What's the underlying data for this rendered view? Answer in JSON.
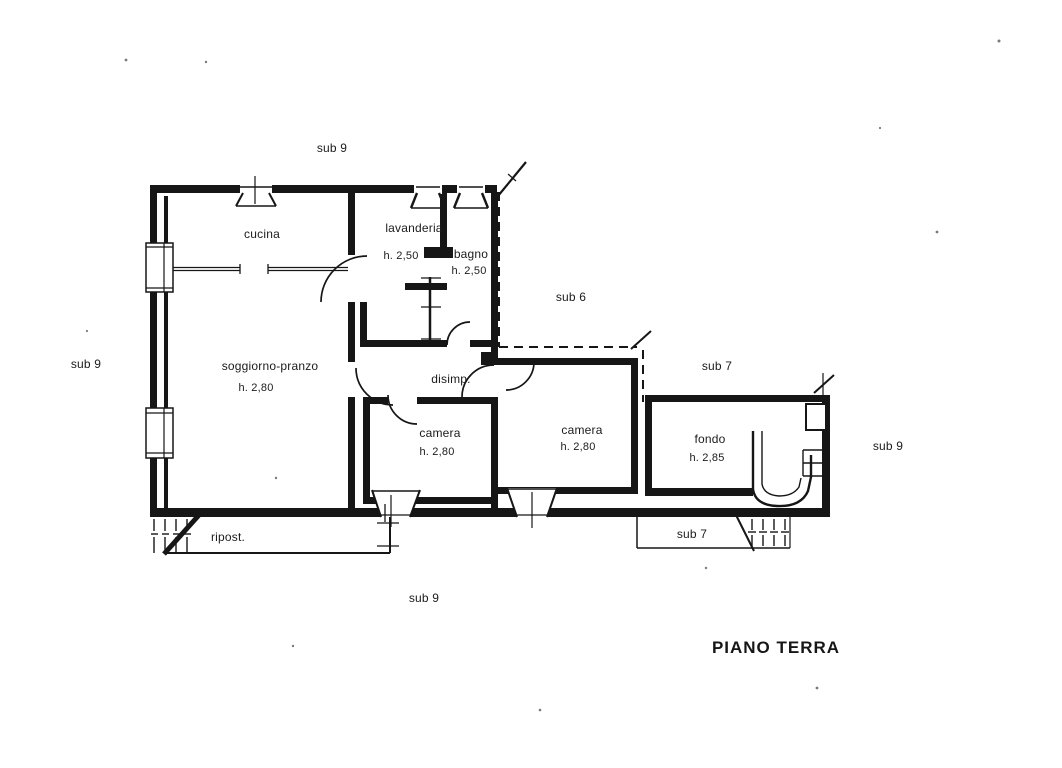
{
  "title": "PIANO TERRA",
  "rooms": {
    "cucina": {
      "label": "cucina"
    },
    "lavanderia": {
      "label": "lavanderia",
      "height": "h. 2,50"
    },
    "bagno": {
      "label": "bagno",
      "height": "h. 2,50"
    },
    "soggiorno": {
      "label": "soggiorno-pranzo",
      "height": "h. 2,80"
    },
    "disimpegno": {
      "label": "disimp."
    },
    "camera1": {
      "label": "camera",
      "height": "h. 2,80"
    },
    "camera2": {
      "label": "camera",
      "height": "h. 2,80"
    },
    "fondo": {
      "label": "fondo",
      "height": "h. 2,85"
    },
    "ripostiglio": {
      "label": "ripost."
    }
  },
  "subalterns": {
    "sub9_top": "sub 9",
    "sub9_left": "sub 9",
    "sub9_bottom": "sub 9",
    "sub9_right": "sub 9",
    "sub6": "sub 6",
    "sub7_upper": "sub 7",
    "sub7_band": "sub 7"
  },
  "ink_color": "#161616"
}
